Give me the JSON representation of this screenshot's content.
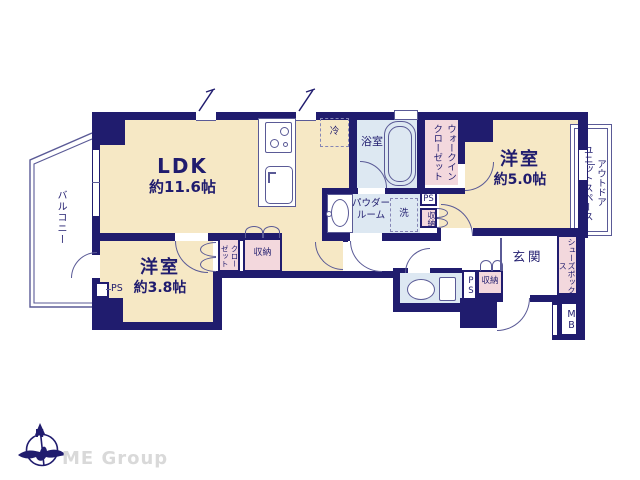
{
  "floorplan": {
    "rooms": {
      "ldk": {
        "name": "LDK",
        "area": "約11.6帖"
      },
      "bedroom_5": {
        "name": "洋室",
        "area": "約5.0帖"
      },
      "bedroom_38": {
        "name": "洋室",
        "area": "約3.8帖"
      },
      "bathroom": {
        "name": "浴室"
      },
      "powder_room": {
        "name_line1": "パウダー",
        "name_line2": "ルーム"
      },
      "entrance": {
        "name": "玄関"
      },
      "balcony": {
        "name": "バルコニー"
      },
      "walk_in_closet": {
        "name_col1": "ウォークイン",
        "name_col2": "クローゼット"
      },
      "outdoor_unit_space": {
        "name_col1": "アウトドア",
        "name_col2": "ユニットスペース"
      }
    },
    "fixtures": {
      "refrigerator": "冷",
      "washer": "洗",
      "closet_col1": "クロー",
      "closet_col2": "ゼット",
      "storage_ldk": "収納",
      "storage_hall": "収納",
      "storage_entrance": "収納",
      "shoe_box": "シューズボックス",
      "meter_box": "MB",
      "pipe_space_hall": "PS",
      "pipe_space_toilet": "PS",
      "pipe_space_bedroom": "PS"
    },
    "compass": {
      "north_label": "N"
    },
    "logo": {
      "text": "ME Group"
    },
    "colors": {
      "wall": "#201c6e",
      "room_floor": "#f6e8c5",
      "wet_area": "#dde8f2",
      "storage_pink": "#f3d8dd",
      "thin_line": "#5a5a96",
      "logo_gray": "#d9d9d9"
    }
  }
}
